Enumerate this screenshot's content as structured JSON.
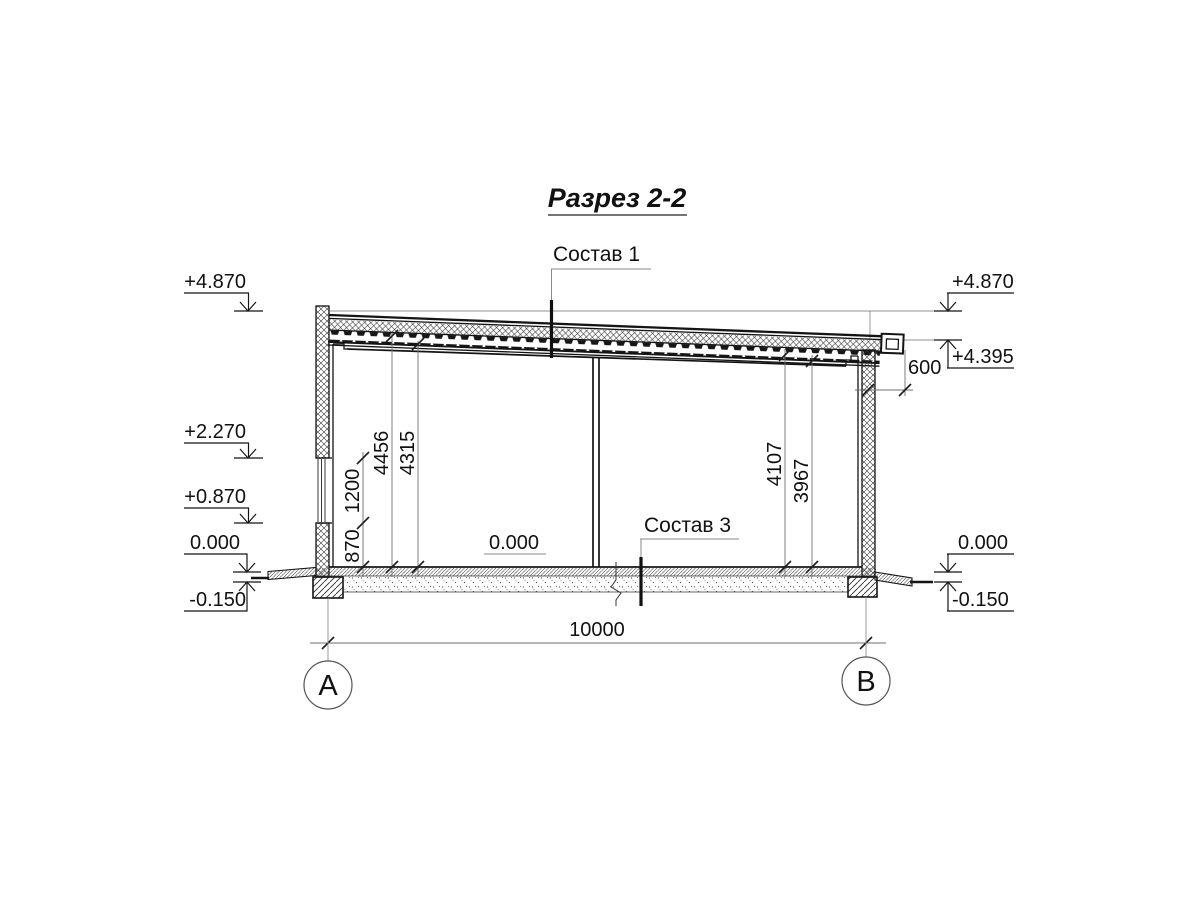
{
  "drawing": {
    "title": "Разрез 2-2",
    "callouts": {
      "roof_composition": "Состав 1",
      "floor_composition": "Состав 3",
      "interior_floor_level": "0.000"
    },
    "levels": {
      "left_roof_top": "+4.870",
      "left_window_head": "+2.270",
      "left_window_sill": "+0.870",
      "left_floor": "0.000",
      "left_ground": "-0.150",
      "right_roof_top": "+4.870",
      "right_eave": "+4.395",
      "right_floor": "0.000",
      "right_ground": "-0.150"
    },
    "dimensions": {
      "sill_height": "870",
      "window_height": "1200",
      "left_clear_height_deck": "4456",
      "left_clear_height_beam": "4315",
      "right_clear_height_deck": "4107",
      "right_clear_height_beam": "3967",
      "eave_overhang": "600",
      "span": "10000"
    },
    "axes": {
      "left": "А",
      "right": "В"
    },
    "colors": {
      "paper": "#ffffff",
      "line": "#141414",
      "aux": "#8a8a8a"
    }
  }
}
